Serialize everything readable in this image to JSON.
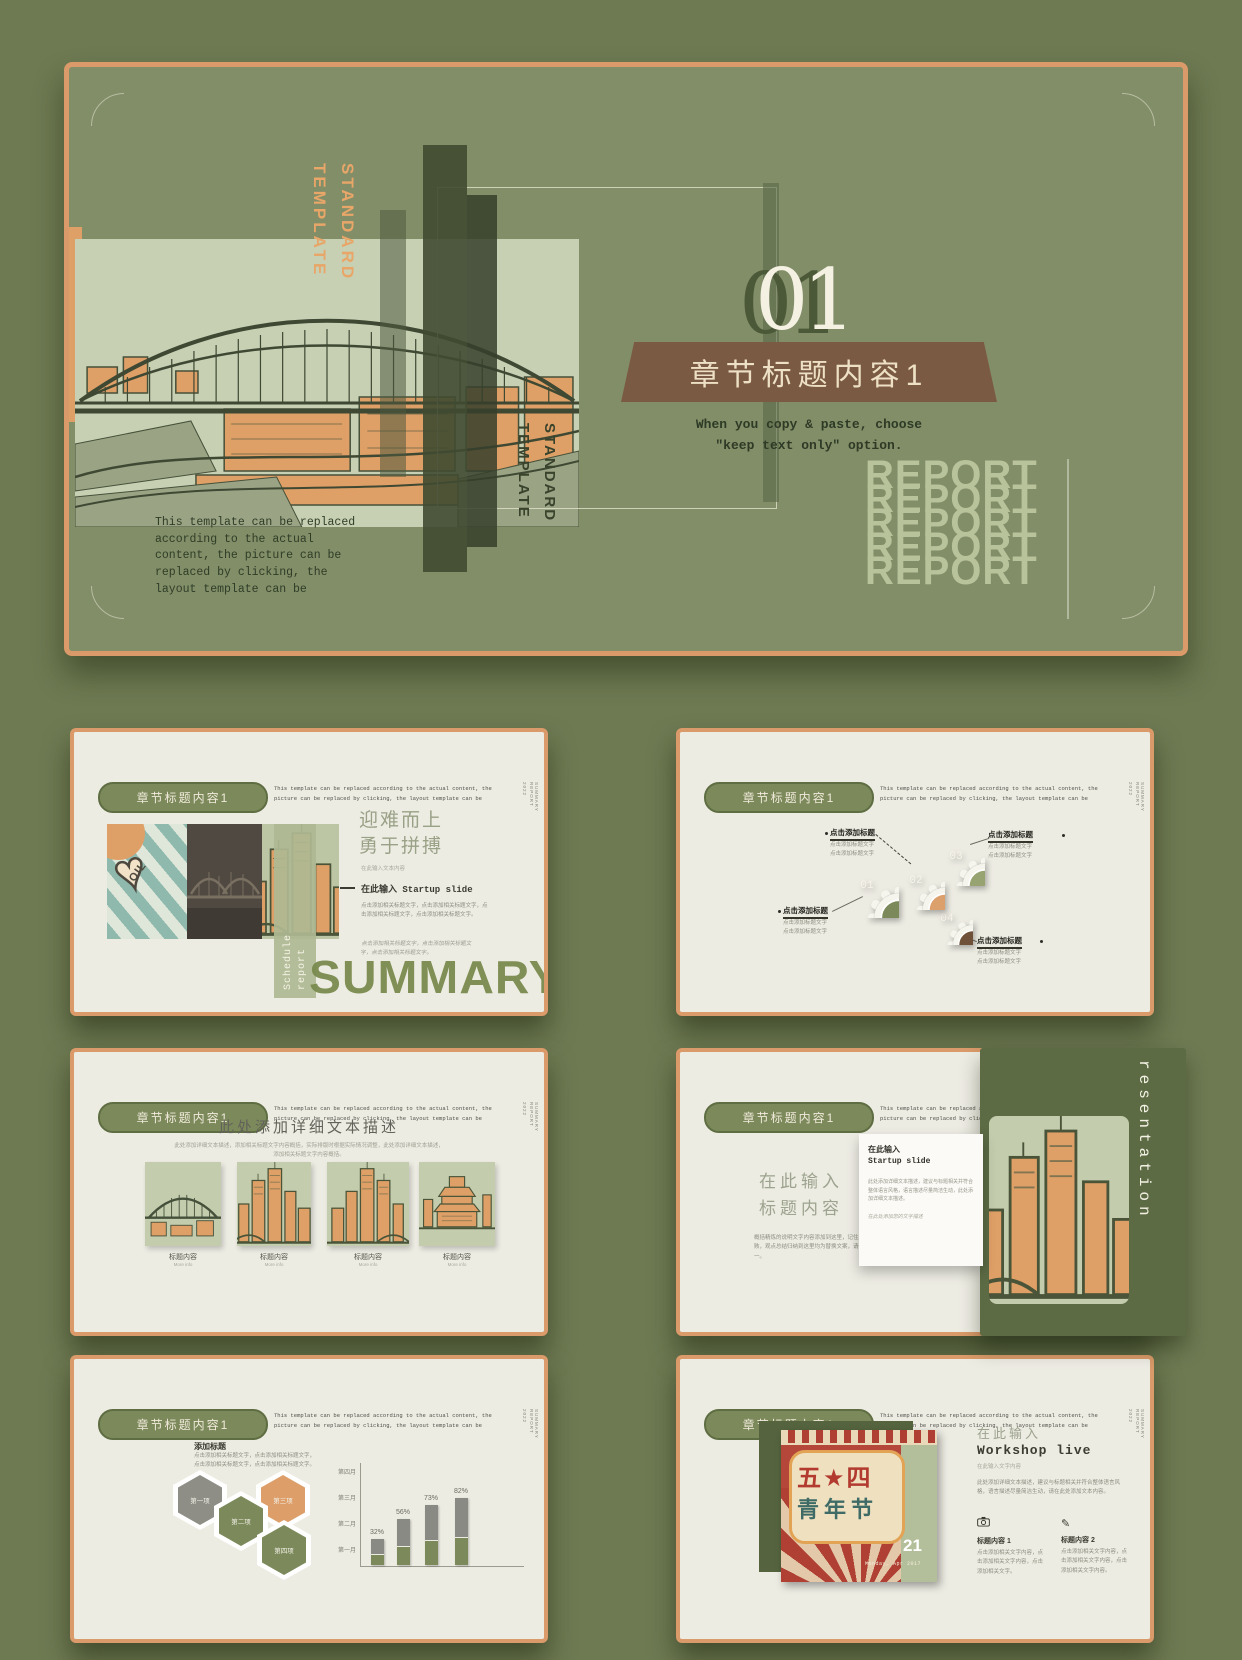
{
  "colors": {
    "page_bg": "#6E7A52",
    "slide_bg": "#EDECE3",
    "accent_orange": "#DA9A69",
    "pill_green": "#7C8A5B",
    "banner_brown": "#7B5A43",
    "sage_image_bg": "#C3CCAD",
    "report_text": "#B8C29B"
  },
  "hero": {
    "side_word1": "STANDARD",
    "side_word2": "TEMPLATE",
    "number": "01",
    "banner_title": "章节标题内容1",
    "caption_line1": "When you copy & paste, choose",
    "caption_line2": "\"keep text only\" option.",
    "paragraph": "This template can be replaced according to the actual content, the picture can be replaced by clicking, the layout template can be",
    "report_word": "REPORT"
  },
  "slide_header": {
    "pill": "章节标题内容1",
    "note": "This template can be replaced according to the actual content, the picture can be replaced by clicking, the layout template can be",
    "side_top": "2022",
    "side_bottom": "SUMMARY REPORT"
  },
  "slide_summary": {
    "oil": "OIL",
    "schedule": "Schedule",
    "report": "report",
    "heading_line1": "迎难而上",
    "heading_line2": "勇于拼搏",
    "lead": "在此输入文本内容",
    "subtitle": "在此输入 Startup slide",
    "para1": "点击添加相关标题文字，点击添加相关标题文字，点击添加相关标题文字，点击添加相关标题文字。",
    "para2": "点击添加相关标题文字，点击添加相关标题文字，点击添加相关标题文字。",
    "big_word": "SUMMARY"
  },
  "slide_gears": {
    "label_title": "点击添加标题",
    "label_line1": "点击添加标题文字",
    "label_line2": "点击添加标题文字",
    "gears": [
      {
        "num": "01",
        "color": "#7C8A5B"
      },
      {
        "num": "02",
        "color": "#DCA06C"
      },
      {
        "num": "03",
        "color": "#97A472"
      },
      {
        "num": "04",
        "color": "#6E5138"
      }
    ]
  },
  "slide_gallery": {
    "title": "此处添加详细文本描述",
    "subtitle_line1": "此处添加详细文本描述，添加相关标题文字内容概括，实际排版时根据实际情况调整，此处添加详细文本描述，",
    "subtitle_line2": "添加相关标题文字内容概括。",
    "items": [
      {
        "caption": "标题内容",
        "sub": "More info"
      },
      {
        "caption": "标题内容",
        "sub": "More info"
      },
      {
        "caption": "标题内容",
        "sub": "More info"
      },
      {
        "caption": "标题内容",
        "sub": "More info"
      }
    ]
  },
  "slide_startup": {
    "big_line1": "在此输入",
    "big_line2": "标题内容",
    "para": "概括精炼的说明文字内容添加到这里，记住尽量言简意赅，观点总结归纳到这里均为替换文案，请保持排版统一。",
    "card_title_line1": "在此输入",
    "card_title_line2": "Startup slide",
    "card_para": "此处添加详细文本描述，建议与标题相关并符合整体语言风格，语言描述尽量简洁生动，此处添加详细文本描述。",
    "card_note": "在此处添加您的文字描述",
    "vertical_word": "resentation"
  },
  "slide_stats": {
    "heading": "添加标题",
    "para": "点击添加相关标题文字，点击添加相关标题文字，点击添加相关标题文字，点击添加相关标题文字。",
    "hexagons": [
      {
        "label": "第一项",
        "color": "#8E8E86"
      },
      {
        "label": "第二项",
        "color": "#7C8A5B"
      },
      {
        "label": "第三项",
        "color": "#DD9E69"
      },
      {
        "label": "第四项",
        "color": "#7C8A5B"
      }
    ],
    "chart": {
      "type": "bar",
      "values": [
        32,
        56,
        73,
        82
      ],
      "labels": [
        "32%",
        "56%",
        "73%",
        "82%"
      ],
      "y_axis_labels": [
        "第四月",
        "第三月",
        "第二月",
        "第一月"
      ],
      "bar_top_color": "#8A8A84",
      "bar_bottom_color": "#7C8A5B"
    }
  },
  "slide_workshop": {
    "intro": "在此输入",
    "title": "Workshop live",
    "lead": "在此输入文字内容",
    "para": "此处添加详细文本描述，建议与标题相关并符合整体语言风格，语言描述尽量简洁生动，请在此处添加文本内容。",
    "columns": [
      {
        "title": "标题内容 1",
        "text": "点击添加相关文字内容，点击添加相关文字内容，点击添加相关文字。"
      },
      {
        "title": "标题内容 2",
        "text": "点击添加相关文字内容，点击添加相关文字内容，点击添加相关文字内容。"
      }
    ],
    "poster": {
      "char_row1": "五★四",
      "char_row2": "青年节",
      "day": "21",
      "date": "Monday, Apr 2017"
    }
  }
}
